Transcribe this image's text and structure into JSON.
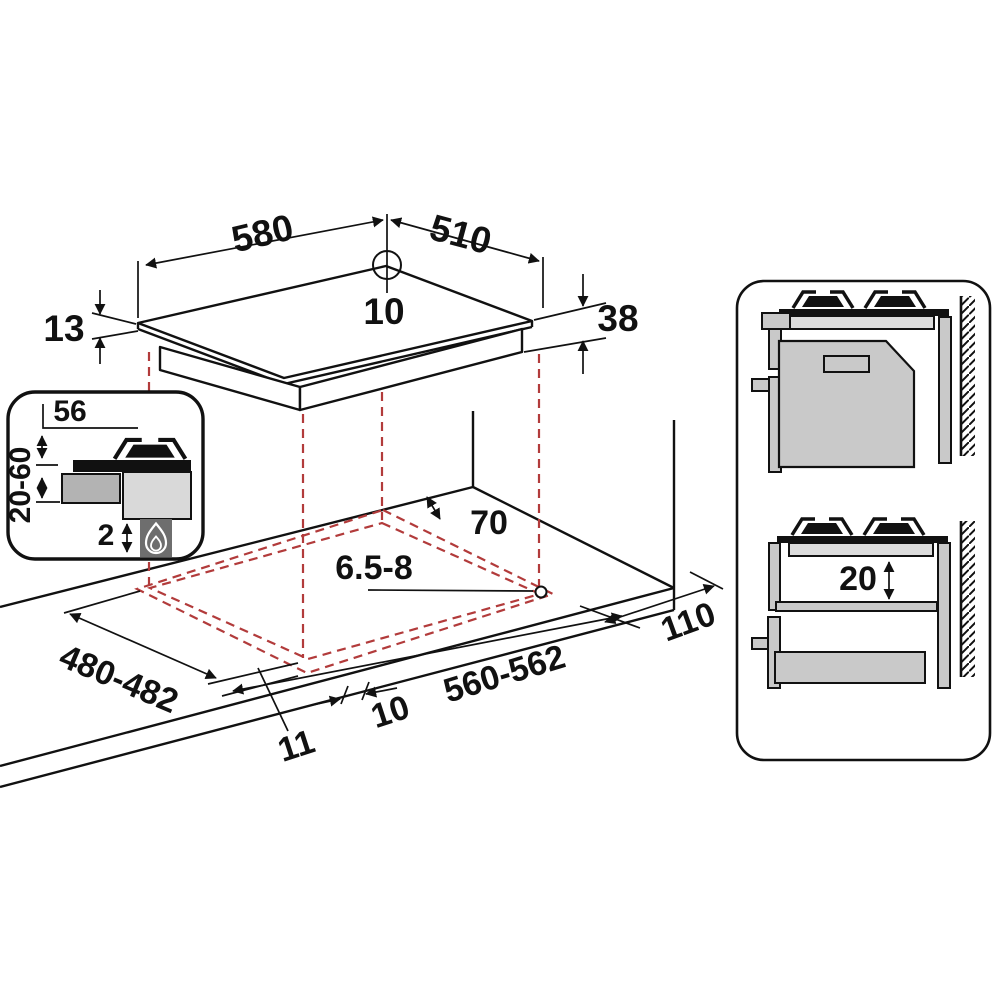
{
  "drawing": {
    "hob": {
      "width_mm": "580",
      "depth_mm": "510",
      "hole_offset_mm": "10",
      "rim_thickness_mm": "13",
      "body_height_mm": "38"
    },
    "detail_inset": {
      "side_clearance_mm": "56",
      "worktop_thickness_mm": "20-60",
      "bottom_clearance_mm": "2"
    },
    "worktop": {
      "rear_clearance_mm": "70",
      "fixing_hole_mm": "6.5-8",
      "cutout_depth_mm": "480-482",
      "cutout_width_mm": "560-562",
      "right_clearance_mm": "110",
      "front_edge_left_mm": "11",
      "front_overhang_mm": "10"
    },
    "side_views": {
      "under_hob_clearance_mm": "20"
    },
    "icons": {
      "flame_icon": "gas-flame",
      "wall_hatching": "wall-section-hatch"
    },
    "colors": {
      "line": "#111111",
      "projection_red": "#b23b3b",
      "worktop_gray": "#dcdcdc",
      "cabinet_gray": "#c9c9c9",
      "drawer_gray": "#b3b3b3",
      "flame_box_gray": "#6e6e6e"
    }
  }
}
